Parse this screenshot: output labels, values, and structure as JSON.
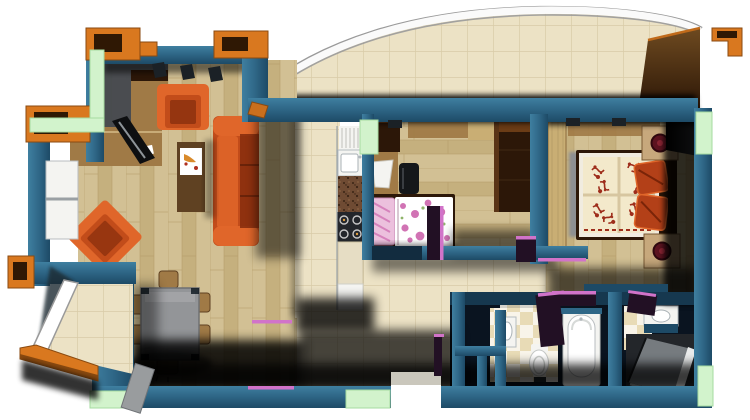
{
  "scene": {
    "type": "apartment-floor-plan-3d-render",
    "view": "top-down",
    "rooms": [
      {
        "id": "living-room",
        "furniture": [
          "tv-cabinet",
          "tv",
          "tall-cabinet",
          "armchair",
          "armchair-rotated",
          "sofa",
          "coffee-table",
          "dining-table",
          "dining-chairs",
          "wall-shelf-niches",
          "windows"
        ]
      },
      {
        "id": "kitchen",
        "furniture": [
          "fridge",
          "sink",
          "counter",
          "stove",
          "base-cabinet"
        ]
      },
      {
        "id": "small-bedroom",
        "furniture": [
          "cabinet",
          "desk",
          "chair",
          "single-bed-floral",
          "wardrobe"
        ]
      },
      {
        "id": "master-bedroom",
        "furniture": [
          "double-bed-damask-quilt",
          "pillows",
          "nightstand-with-lamp",
          "nightstand-with-lamp",
          "gray-wardrobe",
          "door-leaf"
        ]
      },
      {
        "id": "hallway",
        "furniture": [
          "entrance-door-opening"
        ]
      },
      {
        "id": "bathroom",
        "furniture": [
          "sink",
          "toilet",
          "bathtub"
        ]
      },
      {
        "id": "shower-room",
        "furniture": [
          "sink",
          "shower-enclosure"
        ]
      },
      {
        "id": "curved-balcony",
        "furniture": [
          "tiled-floor",
          "curved-railing",
          "end-wall"
        ]
      },
      {
        "id": "lower-balcony",
        "furniture": [
          "tiled-floor",
          "diagonal-railing",
          "planter-frame"
        ]
      }
    ]
  },
  "colors": {
    "wall": "#2f6787",
    "wallLight": "#3f7fa0",
    "wallDark": "#1d4a66",
    "wallDeep": "#122c3f",
    "ink": "#0a141d",
    "mint": "#d2f3cc",
    "mintEdge": "#a6dba0",
    "capOrange": "#d9781f",
    "capOrangeDark": "#8a4a10",
    "capInner": "#2f1804",
    "furnOrange": "#c24c1a",
    "furnOrangeHi": "#e0662a",
    "furnOrangeLo": "#8a2f0e",
    "wood": "#a07a46",
    "woodDark": "#5f4122",
    "woodDeep": "#2c1708",
    "woodTop": "#6b3c16",
    "floorA": "#d2c094",
    "floorB": "#c5b07e",
    "floorLine": "#b49a66",
    "tile": "#ece2c5",
    "tileLine": "#d8cba8",
    "checkA": "#e8dbb6",
    "checkB": "#f8f4e9",
    "counterBrown": "#6f4b33",
    "counterDot": "#3a2414",
    "counterHi": "#8a6242",
    "stove": "#23262b",
    "steel": "#aeb6bb",
    "white": "#f4f4f1",
    "pureWhite": "#ffffff",
    "grayTable": "#939598",
    "grayZone": "#45484d",
    "grayWard": "#9a9c9e",
    "tv": "#0e0f11",
    "brown": "#6e4a20",
    "brownDark": "#2a1506",
    "pink": "#d173b4",
    "pinkLight": "#ecc0dd",
    "quiltCream": "#f3e9cb",
    "quiltRed": "#9e2d1b",
    "rust": "#b34018",
    "lampRed": "#5c1320",
    "lampRim": "#30080f",
    "magenta": "#d173c9",
    "doorPurple": "#221024",
    "railWhite": "#fafafa",
    "railGray": "#9a9a9a",
    "glass": "#7b8084",
    "glassHi": "#e9ebeb",
    "black": "#000000"
  }
}
